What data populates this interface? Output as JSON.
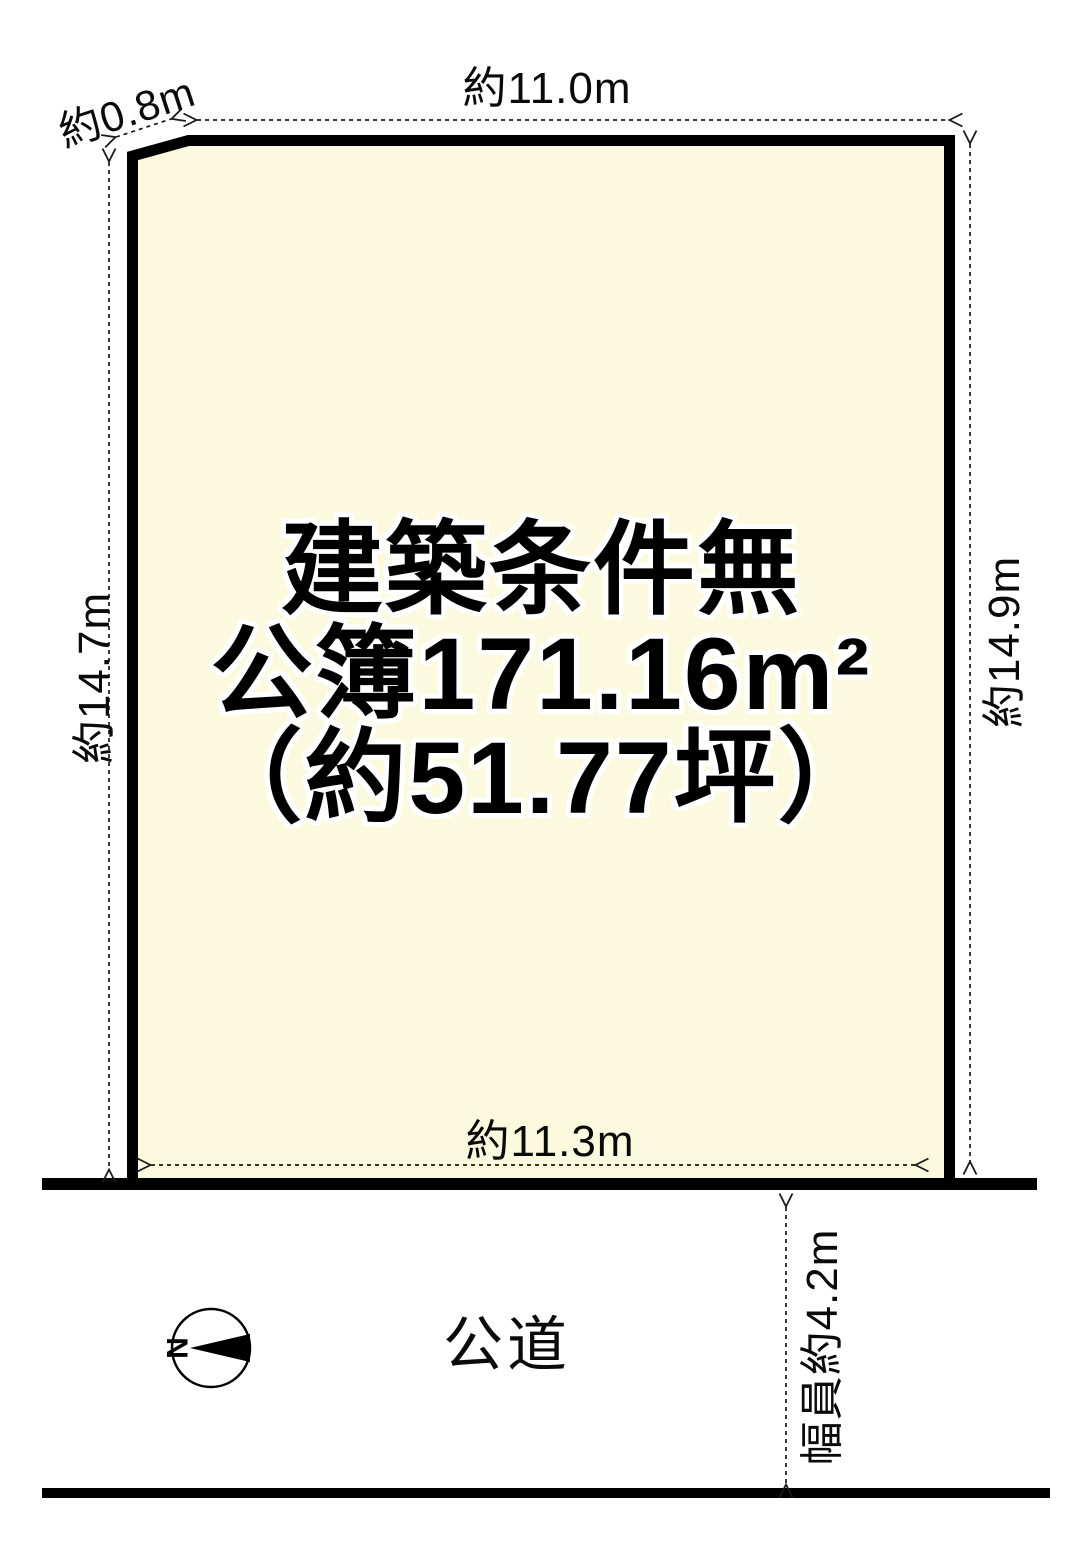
{
  "plot": {
    "line1": "建築条件無",
    "line2": "公簿171.16m²",
    "line3": "（約51.77坪）"
  },
  "dimensions": {
    "top_edge": "約11.0m",
    "bottom_edge": "約11.3m",
    "left_edge": "約14.7m",
    "right_edge": "約14.9m",
    "corner_cut": "約0.8m",
    "road_width": "幅員約4.2m"
  },
  "road": {
    "name": "公道"
  },
  "compass": {
    "north": "N"
  },
  "colors": {
    "plot_fill": "#fcfade",
    "line": "#000000",
    "dash": "#1a1a1a",
    "background": "#ffffff"
  }
}
